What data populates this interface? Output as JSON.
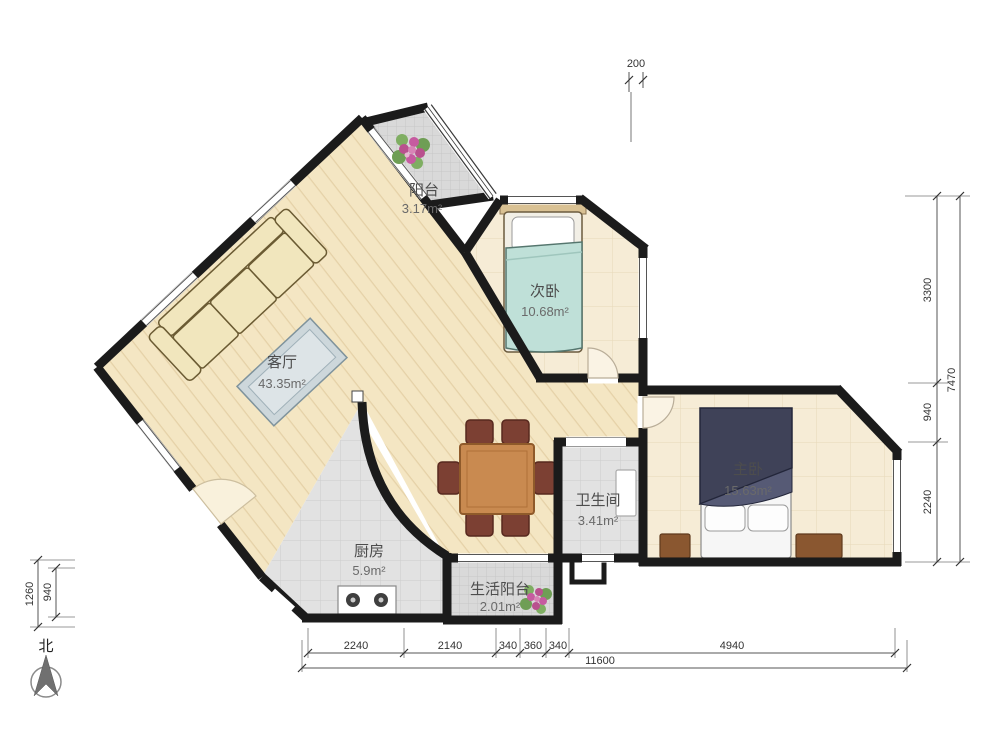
{
  "rooms": {
    "balcony": {
      "label": "阳台",
      "area": "3.17m²"
    },
    "second_bedroom": {
      "label": "次卧",
      "area": "10.68m²"
    },
    "living_room": {
      "label": "客厅",
      "area": "43.35m²"
    },
    "master_bedroom": {
      "label": "主卧",
      "area": "15.63m²"
    },
    "bathroom": {
      "label": "卫生间",
      "area": "3.41m²"
    },
    "kitchen": {
      "label": "厨房",
      "area": "5.9m²"
    },
    "service_balcony": {
      "label": "生活阳台",
      "area": "2.01m²"
    }
  },
  "dims": {
    "top": [
      "200"
    ],
    "right": [
      "3300",
      "940",
      "2240"
    ],
    "right_total": "7470",
    "left": [
      "1260",
      "940"
    ],
    "bottom": [
      "2240",
      "2140",
      "340",
      "360",
      "340",
      "4940"
    ],
    "bottom_total": "11600"
  },
  "compass": {
    "north": "北"
  },
  "colors": {
    "wall": "#1b1b1b",
    "wood_floor": "#f4e6c3",
    "tile_gray": "#dcdcdc",
    "bed_teal": "#bfe0d8",
    "bed_navy": "#3f4258",
    "table_brown": "#c98a50"
  }
}
